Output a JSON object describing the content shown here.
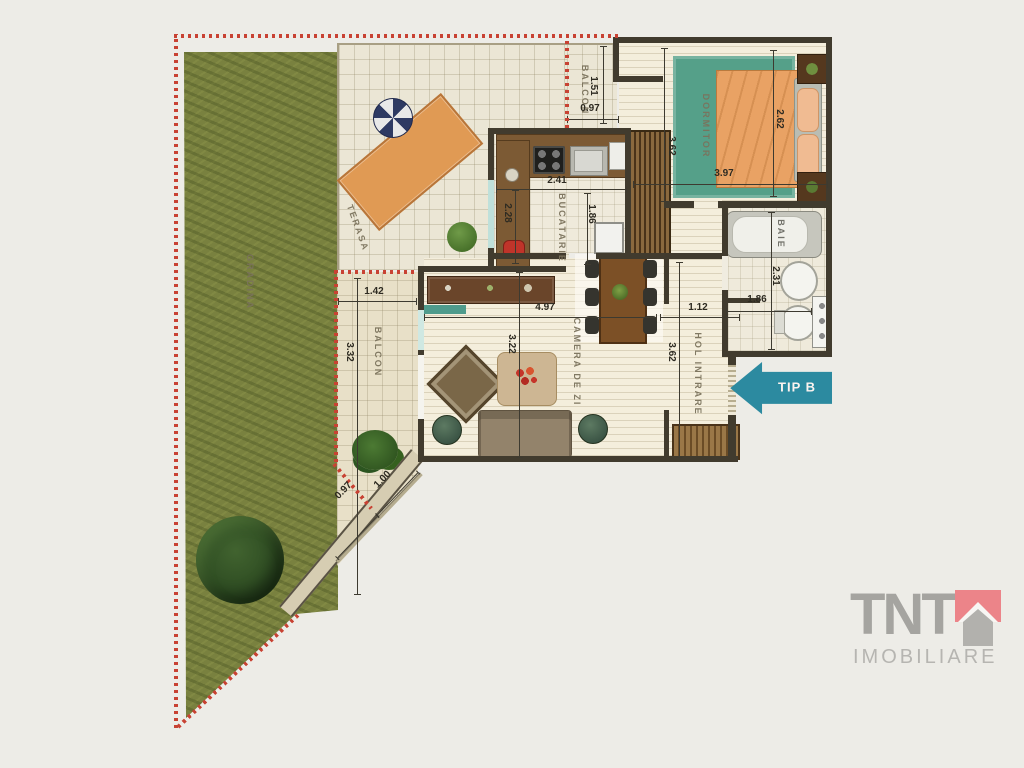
{
  "plan": {
    "arrow_label": "TIP B",
    "rooms": {
      "gradina": "GRADINA",
      "terasa": "TERASA",
      "balcon_top": "BALCON",
      "balcon_left": "BALCON",
      "bucatarie": "BUCATARIE",
      "camera_de_zi": "CAMERA DE ZI",
      "dormitor": "DORMITOR",
      "baie": "BAIE",
      "hol_intrare": "HOL INTRARE"
    },
    "dims": {
      "balcon_top_h": "1.51",
      "balcon_top_w": "0.97",
      "dormitor_h": "3.62",
      "bed_len": "2.62",
      "dormitor_w": "3.97",
      "bucatarie_w": "2.41",
      "bucatarie_left": "2.28",
      "bucatarie_h": "1.86",
      "living_w": "4.97",
      "living_h": "3.22",
      "hol_w": "1.12",
      "hol_h": "3.62",
      "baie_h": "2.31",
      "baie_w": "1.86",
      "balcon_left_w": "1.42",
      "balcon_left_h": "3.32",
      "diag_a": "0.97",
      "diag_b": "1.00"
    },
    "colors": {
      "boundary_red": "#c84233",
      "accent_teal": "#2c8aa0",
      "garden_green": "#79813f",
      "wall_dark": "#413b2e",
      "logo_roof": "#ec8489"
    }
  },
  "logo": {
    "name": "TNT",
    "subtitle": "IMOBILIARE"
  }
}
